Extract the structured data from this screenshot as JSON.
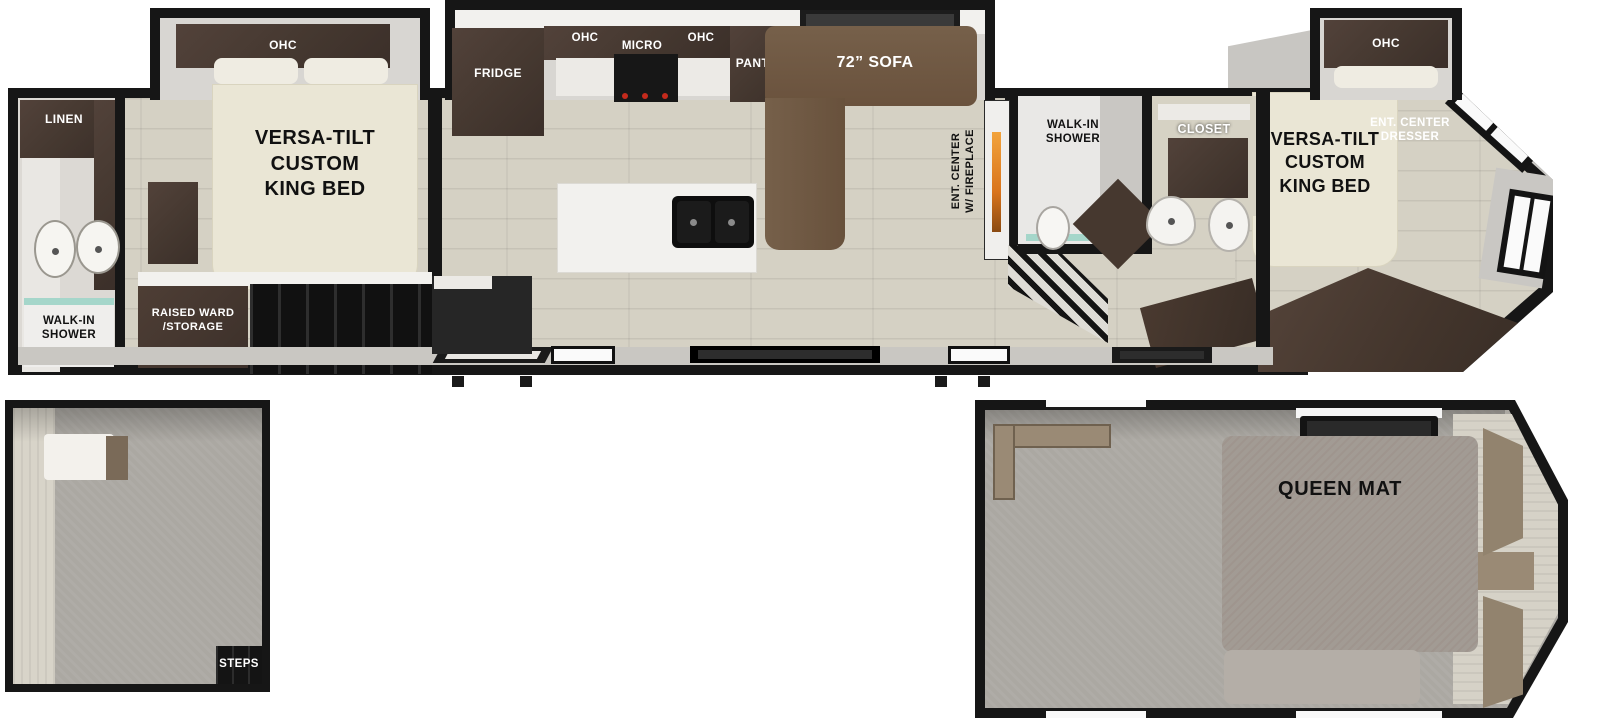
{
  "labels": {
    "rear_bath": {
      "linen": "LINEN",
      "walk_in_shower": "WALK-IN\nSHOWER"
    },
    "rear_bedroom": {
      "ohc": "OHC",
      "bed": "VERSA-TILT\nCUSTOM\nKING BED",
      "raised_ward": "RAISED WARD\n/STORAGE"
    },
    "kitchen": {
      "fridge": "FRIDGE",
      "ohc_left": "OHC",
      "micro": "MICRO",
      "ohc_right": "OHC",
      "pantry": "PANTRY"
    },
    "living": {
      "sofa": "72” SOFA",
      "ent_center": "ENT. CENTER\nW/ FIREPLACE"
    },
    "mid_bath": {
      "walk_in_shower": "WALK-IN\nSHOWER",
      "closet": "CLOSET"
    },
    "front_bedroom": {
      "ohc": "OHC",
      "bed": "VERSA-TILT\nCUSTOM\nKING BED",
      "dresser": "ENT. CENTER\nDRESSER"
    },
    "left_loft": {
      "steps": "STEPS"
    },
    "right_loft": {
      "queen_mat": "QUEEN MAT"
    }
  },
  "colors": {
    "wall": "#161616",
    "floor_wood": "#d5d1c4",
    "cabinet_dark": "#4a3b33",
    "sofa_brown": "#6f5741",
    "bed_cream": "#eae6d5",
    "carpet_gray": "#aba8a2",
    "mat_gray": "#a29b94",
    "fireplace_orange": "#d97a1e",
    "glass_teal": "#a5d6ca"
  }
}
